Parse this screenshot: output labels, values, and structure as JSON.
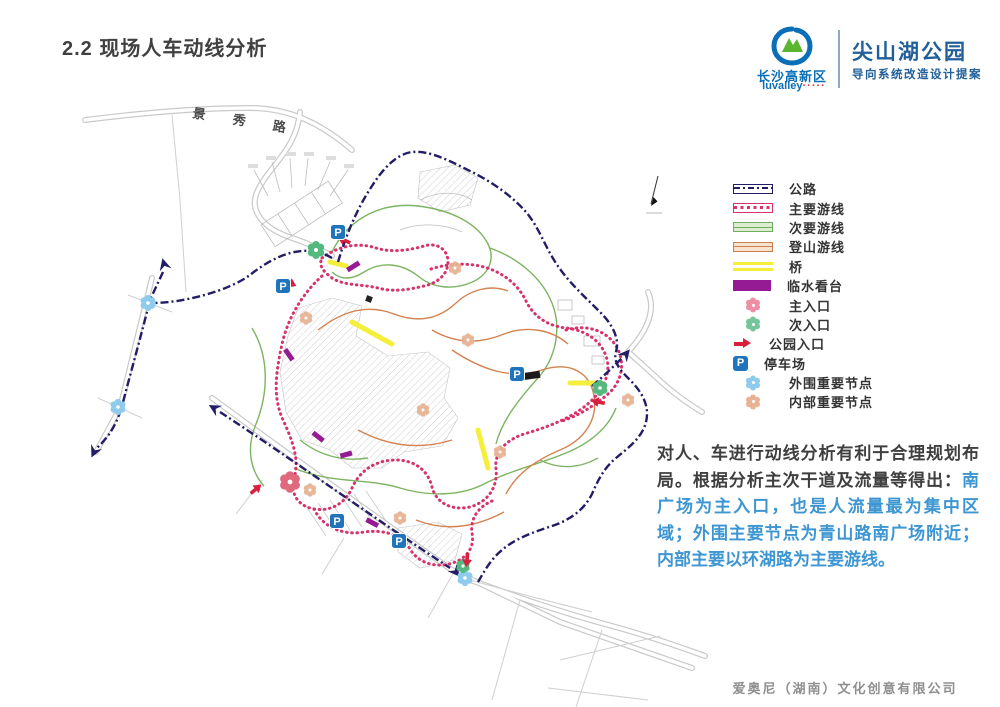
{
  "page": {
    "title": "2.2 现场人车动线分析",
    "footer": "爱奥尼（湖南）文化创意有限公司"
  },
  "brand": {
    "district_name": "长沙高新区",
    "district_latin": "luvalley",
    "district_dots": "·····",
    "park_name": "尖山湖公园",
    "subtitle": "导向系统改造设计提案"
  },
  "map": {
    "road_label": "景 秀 路",
    "parking_glyph": "P"
  },
  "legend": {
    "items": [
      {
        "type": "road",
        "label": "公路"
      },
      {
        "type": "main-route",
        "label": "主要游线"
      },
      {
        "type": "secondary-route",
        "label": "次要游线"
      },
      {
        "type": "climb-route",
        "label": "登山游线"
      },
      {
        "type": "bridge",
        "label": "桥"
      },
      {
        "type": "platform",
        "label": "临水看台"
      },
      {
        "type": "main-entrance",
        "label": "主入口"
      },
      {
        "type": "secondary-entrance",
        "label": "次入口"
      },
      {
        "type": "park-entrance",
        "label": "公园入口"
      },
      {
        "type": "parking",
        "label": "停车场"
      },
      {
        "type": "outer-node",
        "label": "外围重要节点"
      },
      {
        "type": "inner-node",
        "label": "内部重要节点"
      }
    ]
  },
  "analysis": {
    "lead": "对人、车进行动线分析有利于合理规划布局。根据分析主次干道及流量等得出：",
    "highlight": "南广场为主入口，也是人流量最为集中区域；外围主要节点为青山路南广场附近；内部主要以环湖路为主要游线。"
  },
  "colors": {
    "highway_navy": "#221d66",
    "main_route_pink": "#d6336c",
    "secondary_green": "#6fae5e",
    "climb_orange": "#c97e4c",
    "bridge_yellow": "#f5ee3a",
    "platform_purple": "#951b95",
    "entrance_red": "#d81f3d",
    "parking_blue": "#1f74bc",
    "outer_node_blue": "#8ecbec",
    "inner_node_tan": "#e7b394",
    "text_blue": "#3d96d2",
    "brand_blue": "#215f9a"
  }
}
